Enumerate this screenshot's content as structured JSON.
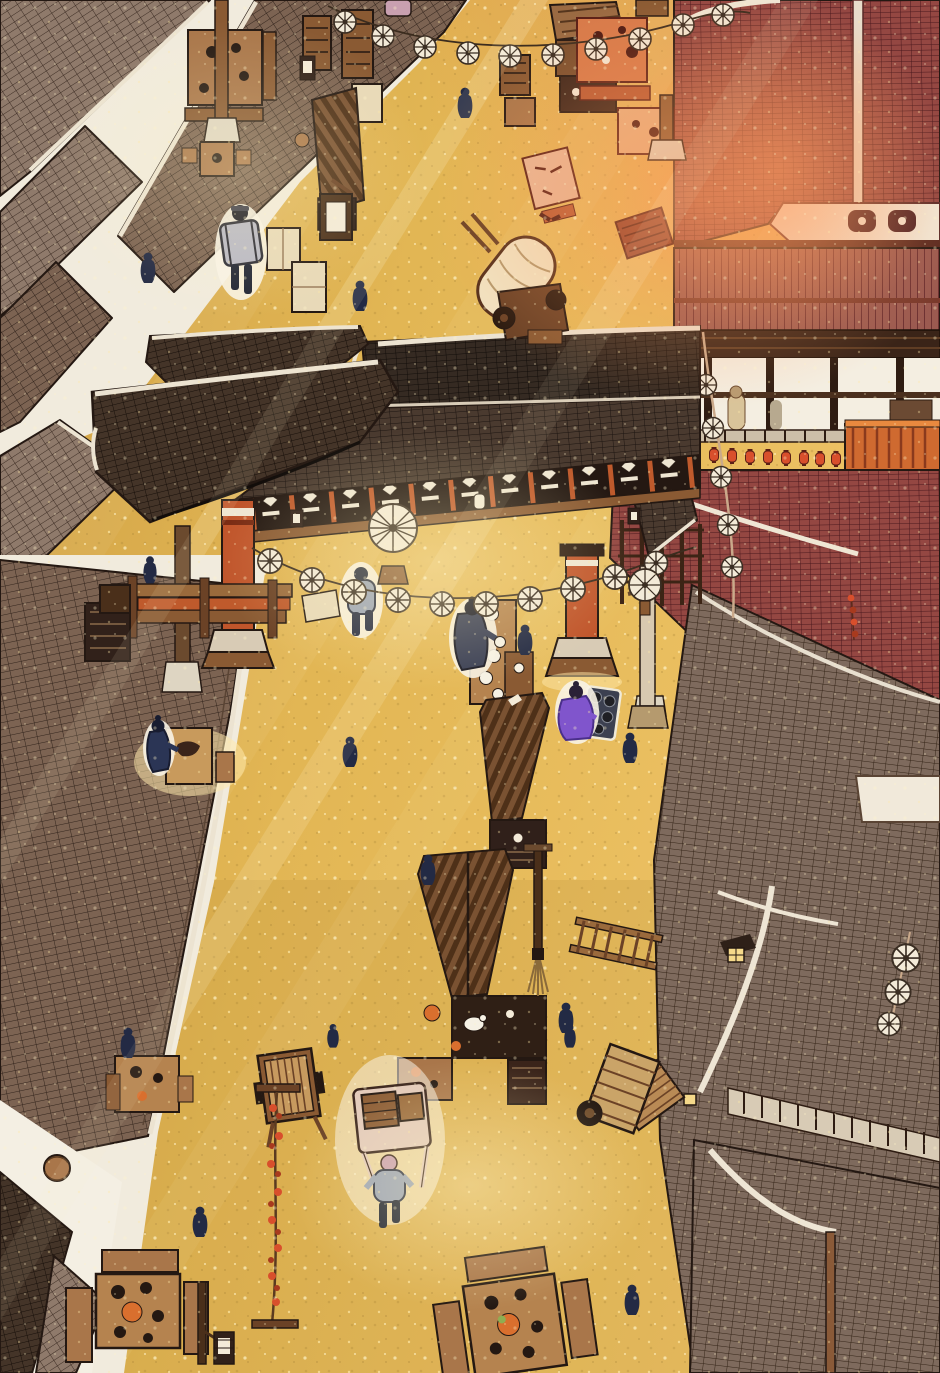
{
  "scene": {
    "title": "Bird's-eye view of a bustling ancient East Asian market street at golden hour",
    "medium": "webtoon illustration panel, no visible text",
    "camera": "top-down aerial, street running diagonally between rooftops",
    "lighting": "warm diagonal sun rays from the upper right, gold sparkle on the road",
    "aria_label": "Overhead illustrated view of a golden sunlit market street lined with tiled rooftops, a red temple roof, a gate pavilion, strings of white paper umbrellas, vendor stalls, wooden tables, carts and small figures in dark robes"
  },
  "palette": {
    "street_gold": "#e2b654",
    "street_gold_light": "#efce74",
    "street_gold_deep": "#c2943e",
    "street_orange": "#e08a4b",
    "ray_light": "#fff4cf",
    "paper_white": "#f2ebdc",
    "roof_gray": "#8f7a6b",
    "roof_gray_line": "#3d2d24",
    "roof_brown": "#7c6352",
    "roof_brown_line": "#32241c",
    "roof_dark": "#4a3a2f",
    "roof_dark_line": "#1c1410",
    "roof_darker": "#352a22",
    "roof_red": "#944742",
    "roof_red_line": "#4a181d",
    "roof_red_rib": "#9b5a50",
    "roof_taupe": "#7e6a5d",
    "roof_taupe_line": "#352518",
    "ridge_white": "#ece3d1",
    "wood_mid": "#a9764a",
    "wood_dark": "#6b4226",
    "wood_light": "#c79a5f",
    "wood_table": "#b5834f",
    "vermillion": "#c0552b",
    "lantern_red": "#d84f2c",
    "umbrella_white": "#f3ead8",
    "umbrella_spoke": "#3a2d22",
    "ink_outline": "#241812",
    "figure_navy": "#232a44",
    "figure_gray_blue": "#9aa3b5",
    "figure_purple": "#8055cc",
    "figure_pack_gray": "#b8b8c4",
    "hat_pink": "#c9a0b0",
    "food_orange": "#d96f2e",
    "frieze_bg": "#241812",
    "canopy_cream": "#f1e3c2"
  },
  "counts": {
    "pedestrian_silhouettes": 14,
    "highlighted_characters": 6,
    "umbrella_garlands": 2,
    "hanging_paper_umbrellas": 23,
    "standing_parasols": 2,
    "red_lanterns_on_railing": 11,
    "market_tables": 9,
    "food_stalls": 6,
    "carts_and_wagons": 4
  },
  "buildings": [
    {
      "name": "top-left-rooftops",
      "desc": "gray-brown tiled roofs on a diagonal with white alleys between them",
      "area": "0,0 to 465,470"
    },
    {
      "name": "left-mid-rooftop",
      "desc": "long brown tiled roof bordering street on the left",
      "area": "0,555 to 265,1170"
    },
    {
      "name": "bottom-left-walls",
      "desc": "white plaster walls with small dark roofs and a clay jar",
      "area": "0,1100 to 125,1373"
    },
    {
      "name": "red-temple-roof",
      "desc": "maroon tiled roof with white vertical ridge and ornamented gable",
      "area": "675,0 to 940,330"
    },
    {
      "name": "right-veranda",
      "desc": "open balcony with railing, row of red lanterns, orange balustrade",
      "area": "620,330 to 940,470"
    },
    {
      "name": "right-lower-roofs",
      "desc": "sweeping red-to-taupe tiled roofs with white ridge caps, dormers, railings",
      "area": "612,470 to 940,1373"
    },
    {
      "name": "gate-pavilion",
      "desc": "dark tiled gate roof spanning the street with ornamental frieze and vermillion columns",
      "area": "92,326 to 700,712"
    }
  ],
  "props": [
    {
      "name": "umbrella-garland-top",
      "pos": "x330-748, y6-58"
    },
    {
      "name": "umbrella-garland-gate",
      "pos": "x252-695, y545-605"
    },
    {
      "name": "umbrella-rope-right",
      "pos": "x703-733, y332-620"
    },
    {
      "name": "umbrella-chain-roof",
      "pos": "x888-912, y935-1035"
    },
    {
      "name": "standing-parasol-large",
      "pos": "393,528"
    },
    {
      "name": "standing-parasol-small",
      "pos": "645,585"
    },
    {
      "name": "covered-wagon",
      "pos": "465,230 to 565,345"
    },
    {
      "name": "hand-cart-highlighted",
      "pos": "352,1080 to 430,1190"
    },
    {
      "name": "slatted-cart",
      "pos": "258,1048 to 318,1145"
    },
    {
      "name": "tipped-cart",
      "pos": "593,1040 to 652,1137"
    },
    {
      "name": "skewer-string",
      "pos": "x270, y1086-1330"
    },
    {
      "name": "vendor-long-table-with-plates",
      "pos": "470,600 to 516,705"
    },
    {
      "name": "pan-mat",
      "pos": "583,688 to 616,738"
    },
    {
      "name": "slat-roof-stall-center",
      "pos": "482,694 to 548,868"
    },
    {
      "name": "slat-roof-stall-lower",
      "pos": "420,850 to 546,1105"
    },
    {
      "name": "stall-screens-left",
      "pos": "267,84 to 382,312"
    },
    {
      "name": "lamp-post-with-tassel",
      "pos": "534,846 to 548,997"
    },
    {
      "name": "ladder-rack",
      "pos": "572,922 to 662,966"
    },
    {
      "name": "tables-bottom-left",
      "pos": "68,1240 to 206,1365"
    },
    {
      "name": "tables-bottom-center",
      "pos": "443,1268 to 585,1372"
    }
  ],
  "people": [
    {
      "name": "walker-alley",
      "type": "navy-silhouette",
      "x": 148,
      "y": 268
    },
    {
      "name": "pack-carrier",
      "type": "highlighted, gray back-rack, black cap",
      "x": 241,
      "y": 250
    },
    {
      "name": "walker-left",
      "type": "navy-silhouette",
      "x": 360,
      "y": 296
    },
    {
      "name": "walker-top",
      "type": "navy-silhouette",
      "x": 465,
      "y": 103
    },
    {
      "name": "walker-gray-top",
      "type": "highlighted, blue-gray jacket",
      "x": 360,
      "y": 598
    },
    {
      "name": "vendor-at-table",
      "type": "highlighted, dark robe serving plates",
      "x": 472,
      "y": 636
    },
    {
      "name": "purple-seller",
      "type": "highlighted, purple robe beside pan mat",
      "x": 578,
      "y": 710
    },
    {
      "name": "seated-at-table",
      "type": "highlighted, navy robe at lit table",
      "x": 160,
      "y": 748
    },
    {
      "name": "cart-puller",
      "type": "highlighted, gray top, pink cap, pulling cart",
      "x": 388,
      "y": 1185
    },
    {
      "name": "bystander-right-of-table",
      "type": "navy-silhouette",
      "x": 525,
      "y": 640
    },
    {
      "name": "walker-mid-left",
      "type": "navy-silhouette",
      "x": 350,
      "y": 752
    },
    {
      "name": "walker-right-pocket",
      "type": "navy-silhouette",
      "x": 630,
      "y": 748
    },
    {
      "name": "walker-center",
      "type": "navy-silhouette",
      "x": 428,
      "y": 870
    },
    {
      "name": "walker-lower-center",
      "type": "navy-silhouette",
      "x": 566,
      "y": 1018
    },
    {
      "name": "walker-left-low",
      "type": "navy-silhouette",
      "x": 128,
      "y": 1043
    },
    {
      "name": "walker-small-1",
      "type": "navy-silhouette",
      "x": 333,
      "y": 1036
    },
    {
      "name": "walker-small-2",
      "type": "navy-silhouette",
      "x": 570,
      "y": 1034
    },
    {
      "name": "walker-bottom-left",
      "type": "navy-silhouette",
      "x": 200,
      "y": 1222
    },
    {
      "name": "walker-bottom-right",
      "type": "navy-silhouette",
      "x": 632,
      "y": 1300
    },
    {
      "name": "figure-on-beam",
      "type": "navy-silhouette seated",
      "x": 150,
      "y": 570
    },
    {
      "name": "veranda-figure",
      "type": "tan robe, inside balcony",
      "x": 736,
      "y": 410
    }
  ]
}
